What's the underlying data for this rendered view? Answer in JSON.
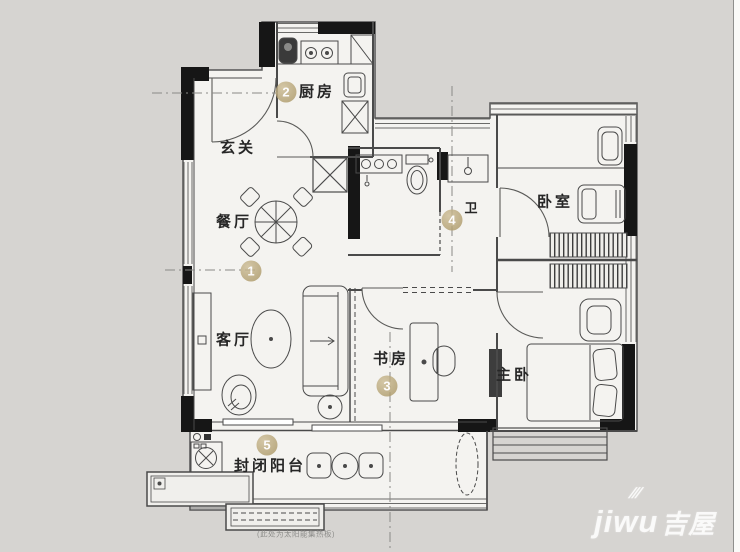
{
  "rooms": {
    "foyer": {
      "label": "玄关"
    },
    "kitchen": {
      "label": "厨房"
    },
    "dining": {
      "label": "餐厅"
    },
    "living": {
      "label": "客厅"
    },
    "bath": {
      "label": "卫"
    },
    "bedroom": {
      "label": "卧室"
    },
    "study": {
      "label": "书房"
    },
    "master": {
      "label": "主卧"
    },
    "balcony": {
      "label": "封闭阳台"
    }
  },
  "markers": {
    "m1": "1",
    "m2": "2",
    "m3": "3",
    "m4": "4",
    "m5": "5"
  },
  "annotation": {
    "solar_note": "(此处为太阳能集热板)"
  },
  "watermark": {
    "brand": "jiwu",
    "brand_cn": "吉屋",
    "wing": "///"
  },
  "colors": {
    "background": "#d6d4d1",
    "floor": "#f4f3f0",
    "wall_black": "#161616",
    "line": "#4a4a4a",
    "marker_gold": "#a6925f",
    "watermark_white": "#ffffff"
  }
}
